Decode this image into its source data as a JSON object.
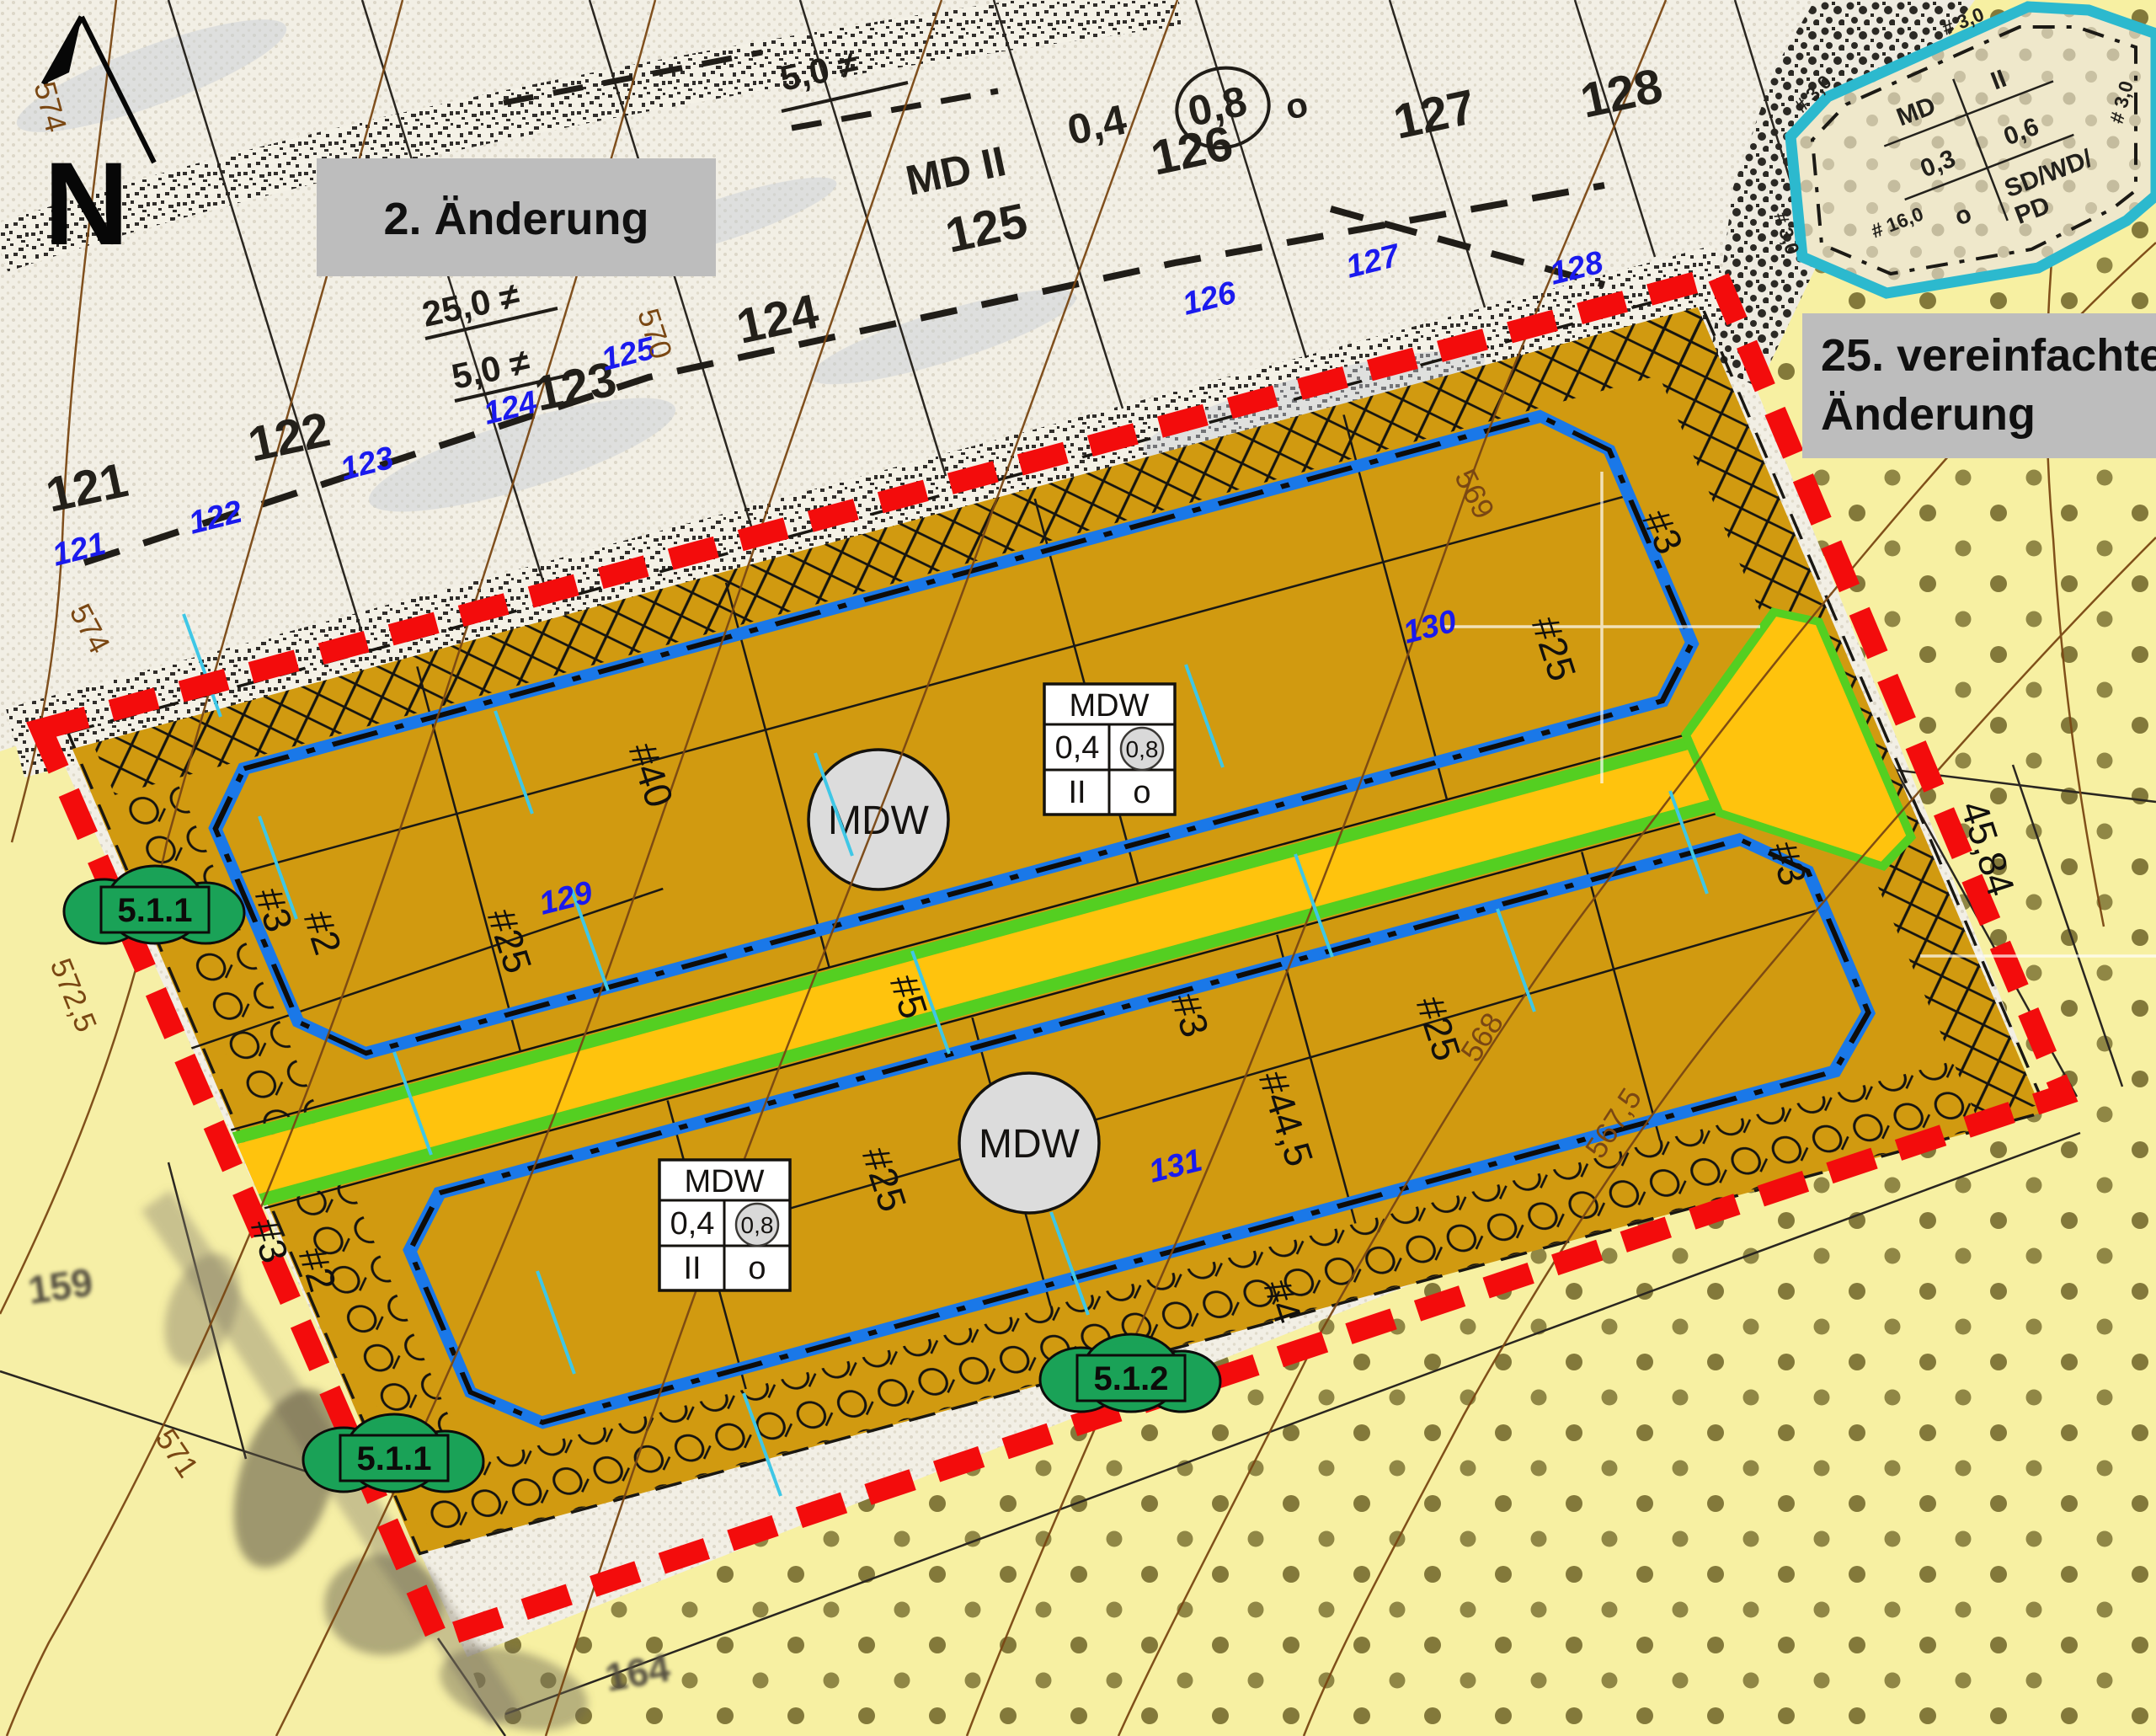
{
  "map": {
    "north_label": "N",
    "annotation_boxes": {
      "change2": "2. Änderung",
      "change25_line1": "25. vereinfachte",
      "change25_line2": "Änderung"
    },
    "old_plan": {
      "parcels": [
        "121",
        "122",
        "123",
        "124",
        "125",
        "126",
        "127",
        "128"
      ],
      "zone": "MD II",
      "grz": "0,4",
      "gfz": "0,8",
      "open_mode": "o",
      "dim_25": "25,0 ≠",
      "dim_5": "5,0 ≠"
    },
    "new_parcel_numbers": {
      "p121": "121",
      "p122": "122",
      "p123": "123",
      "p124": "124",
      "p125": "125",
      "p126": "126",
      "p127": "127",
      "p128": "128",
      "p129": "129",
      "p130": "130",
      "p131": "131"
    },
    "contour_labels": {
      "c574": "574",
      "c5725": "572,5",
      "c571": "571",
      "c570": "570",
      "c569": "569",
      "c568": "568",
      "c5675": "567,5"
    },
    "dimensions": {
      "d2": "#2",
      "d3": "#3",
      "d4": "#4",
      "d5": "#5",
      "d25": "#25",
      "d40": "#40",
      "d445": "#44,5"
    },
    "mdw": {
      "label": "MDW",
      "grz": "0,4",
      "gfz": "0,8",
      "floors": "II",
      "open_mode": "o"
    },
    "markers": {
      "m511": "5.1.1",
      "m512": "5.1.2"
    },
    "cyan_area": {
      "zone": "MD",
      "floors": "II",
      "grz": "0,3",
      "gfz": "0,6",
      "open_mode": "o",
      "roof_line1": "SD/WD/",
      "roof_line2": "PD",
      "dim_16": "# 16,0",
      "dim_3": "# 3,0"
    },
    "measurements": {
      "len4584": "45,84"
    },
    "background_parcels": {
      "p159": "159",
      "p164": "164"
    },
    "colors": {
      "boundary_red": "#f30c0c",
      "building_orange": "#d19a10",
      "road_yellow": "#ffc30d",
      "road_green": "#54cf21",
      "baugrenze_blue": "#1a78e8",
      "marker_green": "#1aa257",
      "cyan_border": "#2cb9ce",
      "contour_brown": "#7a4713",
      "label_blue": "#1a1aee",
      "mdw_circle_gray": "#dcdcdc",
      "annotation_box_gray": "#bdbdbd"
    }
  }
}
